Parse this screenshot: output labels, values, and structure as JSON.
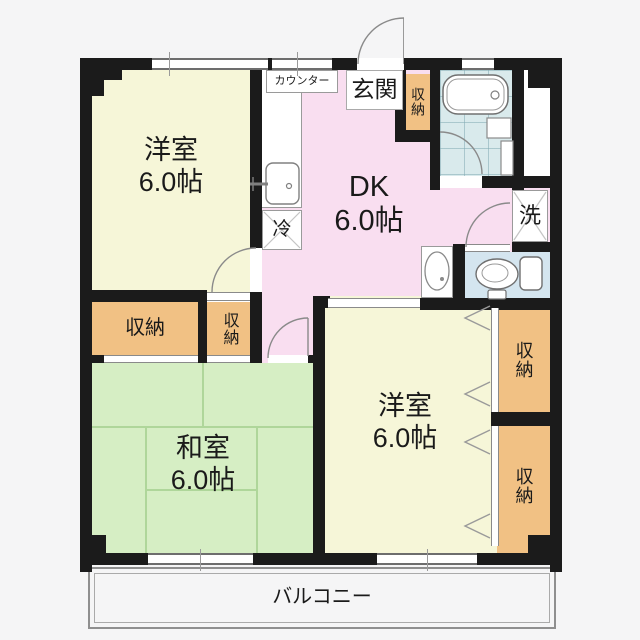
{
  "rooms": {
    "western_a": {
      "label": "洋室",
      "size": "6.0帖"
    },
    "dk": {
      "label": "DK",
      "size": "6.0帖"
    },
    "japanese": {
      "label": "和室",
      "size": "6.0帖"
    },
    "western_b": {
      "label": "洋室",
      "size": "6.0帖"
    },
    "entrance": {
      "label": "玄関"
    },
    "balcony": {
      "label": "バルコニー"
    }
  },
  "fixtures": {
    "storage": "収納",
    "counter": "カウンター",
    "refrigerator": "冷",
    "laundry": "洗"
  },
  "colors": {
    "wall": "#1b1b1b",
    "western-room": "#f6f6d8",
    "dk": "#f9def0",
    "japanese-room": "#d6eec4",
    "storage": "#f1c184",
    "bath-tile": "#d9eaec",
    "toilet-room": "#d4e5ef",
    "bg": "#f5f5f6"
  }
}
